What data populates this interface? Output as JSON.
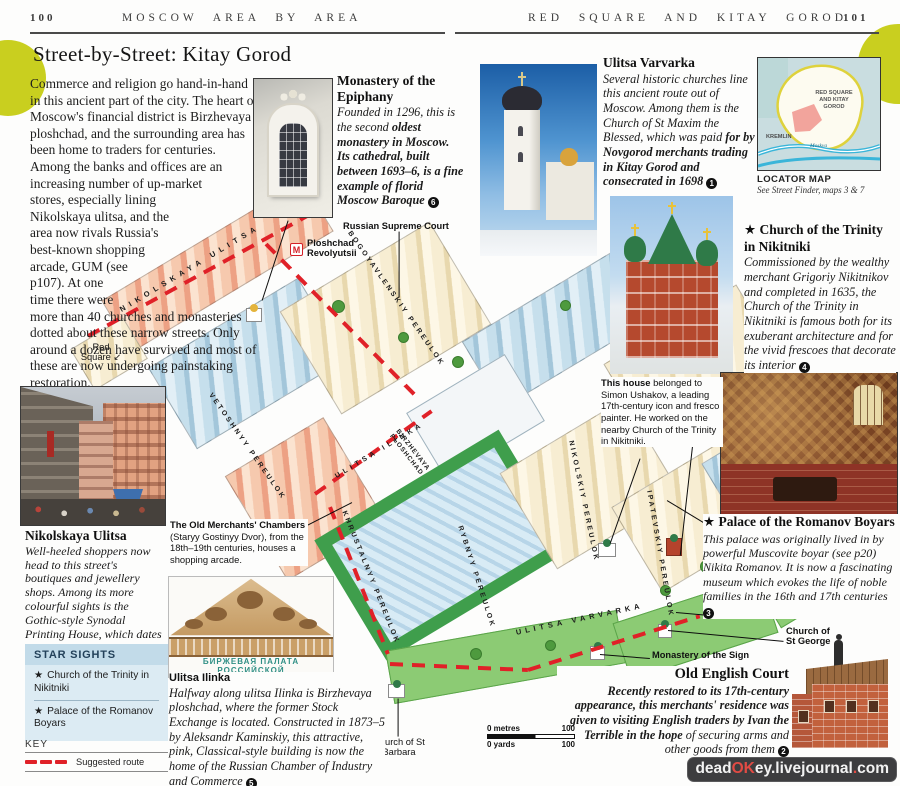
{
  "page": {
    "left_page_num": "100",
    "left_header": "MOSCOW AREA BY AREA",
    "right_header": "RED SQUARE AND KITAY GOROD",
    "right_page_num": "101",
    "title": "Street-by-Street: Kitay Gorod",
    "intro": "Commerce and religion go hand-in-hand in this ancient part of the city. The heart of Moscow's financial district is Birzhevaya ploshchad, and the surrounding area has been home to traders for centuries. Among the banks and offices are an increasing number of up-market stores, especially lining Nikolskaya ulitsa, and the area now rivals Russia's best-known shopping arcade, GUM (see p107). At one time there were more than 40 churches and monasteries dotted about these narrow streets. Only around a dozen have survived and most of these are now undergoing painstaking restoration."
  },
  "annotations": {
    "epiphany": {
      "title": "Monastery of the Epiphany",
      "body_regular": "Founded in 1296, this is the second ",
      "body_bold": "oldest monastery in Moscow. Its cathedral, built between 1693–6, is a fine example of florid Moscow Baroque ",
      "ref": "6"
    },
    "varvarka": {
      "title": "Ulitsa Varvarka",
      "body_regular": "Several historic churches line this ancient route out of Moscow. Among them is the Church of St Maxim the Blessed, which was paid ",
      "body_bold": "for by Novgorod merchants trading in Kitay Gorod and consecrated in 1698 ",
      "ref": "1"
    },
    "trinity": {
      "star": "★",
      "title": "Church of the Trinity in Nikitniki",
      "body": "Commissioned by the wealthy merchant Grigoriy Nikitnikov and completed in 1635, the Church of the Trinity in Nikitniki is famous both for its exuberant architecture and for the vivid frescoes that decorate its interior ",
      "ref": "4"
    },
    "ushakov": {
      "lead": "This house",
      "body": " belonged to Simon Ushakov, a leading 17th-century icon and fresco painter. He worked on the nearby Church of the Trinity in Nikitniki."
    },
    "romanov": {
      "star": "★",
      "title": "Palace of the Romanov Boyars",
      "body": "This palace was originally lived in by powerful Muscovite boyar (see p20) Nikita Romanov. It is now a fascinating museum which evokes the life of noble families in the 16th and 17th centuries ",
      "ref": "3"
    },
    "old_english": {
      "title": "Old English Court",
      "body_bold": "Recently restored to its 17th-century appearance, this merchants' residence was given to visiting English traders by Ivan the Terrible in the hope ",
      "body_regular": "of securing arms and other goods from them ",
      "ref": "2"
    },
    "nikolskaya": {
      "title": "Nikolskaya Ulitsa",
      "body": "Well-heeled shoppers now head to this street's boutiques and jewellery shops. Among its more colourful sights is the Gothic-style Synodal Printing House, which dates from the 19th century ",
      "ref": "7"
    },
    "merchants": {
      "title": "The Old Merchants' Chambers",
      "body": "(Staryy Gostinyy Dvor), from the 18th–19th centuries, houses a shopping arcade."
    },
    "ilinka": {
      "title": "Ulitsa Ilinka",
      "body": "Halfway along ulitsa Ilinka is Birzhevaya ploshchad, where the former Stock Exchange is located. Constructed in 1873–5 by Aleksandr Kaminskiy, this attractive, pink, Classical-style building is now the home of the Russian Chamber of Industry and Commerce ",
      "ref": "5"
    }
  },
  "locator": {
    "caption": "LOCATOR MAP",
    "subcaption": "See Street Finder, maps 3 & 7",
    "area_label_1": "RED SQUARE",
    "area_label_2": "AND KITAY",
    "area_label_3": "GOROD",
    "kremlin_label": "KREMLIN",
    "river_label": "Moskva"
  },
  "star_sights": {
    "title": "STAR SIGHTS",
    "items": [
      {
        "star": "★",
        "label": "Church of the Trinity in Nikitniki"
      },
      {
        "star": "★",
        "label": "Palace of the Romanov Boyars"
      }
    ]
  },
  "key": {
    "title": "KEY",
    "route_label": "Suggested route"
  },
  "map": {
    "streets": [
      "NIKOLSKAYA ULITSA",
      "VETOSHNYY PEREULOK",
      "BOGOYAVLENSKIY PEREULOK",
      "ULITSA ILINKA",
      "BIRZHEVAYA PLOSHCHAD",
      "KHRUSTALNYY PEREULOK",
      "RYBNYY PEREULOK",
      "NIKOLSKIY PEREULOK",
      "IPATEVSKIY PEREULOK",
      "ULITSA VARVARKA"
    ],
    "labels": {
      "supreme_court": "Russian Supreme Court",
      "metro_revolyutsii": "Ploshchad Revolyutsii",
      "red_square": "Red Square",
      "red_square_arrow": "↙",
      "kitay_metro_bold": "Kitay",
      "kitay_metro_rest": " Gorod metro",
      "st_george": "Church of St George",
      "sign_monastery": "Monastery of the Sign",
      "st_barbara": "Church of St Barbara",
      "metro_m": "M"
    },
    "pediment_text": "БИРЖЕВАЯ ПАЛАТА РОССИЙСКОЙ"
  },
  "scale": {
    "metres_0": "0 metres",
    "metres_100": "100",
    "yards_0": "0 yards",
    "yards_100": "100"
  },
  "watermark": {
    "p1": "dead",
    "p2": "OK",
    "p3": "ey",
    "p4": ".",
    "p5": "livejournal",
    "p6": ".",
    "p7": "com"
  },
  "colors": {
    "accent_circle": "#c9cf1f",
    "route_red": "#e02128",
    "star_box_bg": "#dcebf3",
    "star_box_header": "#c2dbe9",
    "watermark_bg": "#3d3d3f",
    "watermark_red": "#e14b44"
  }
}
